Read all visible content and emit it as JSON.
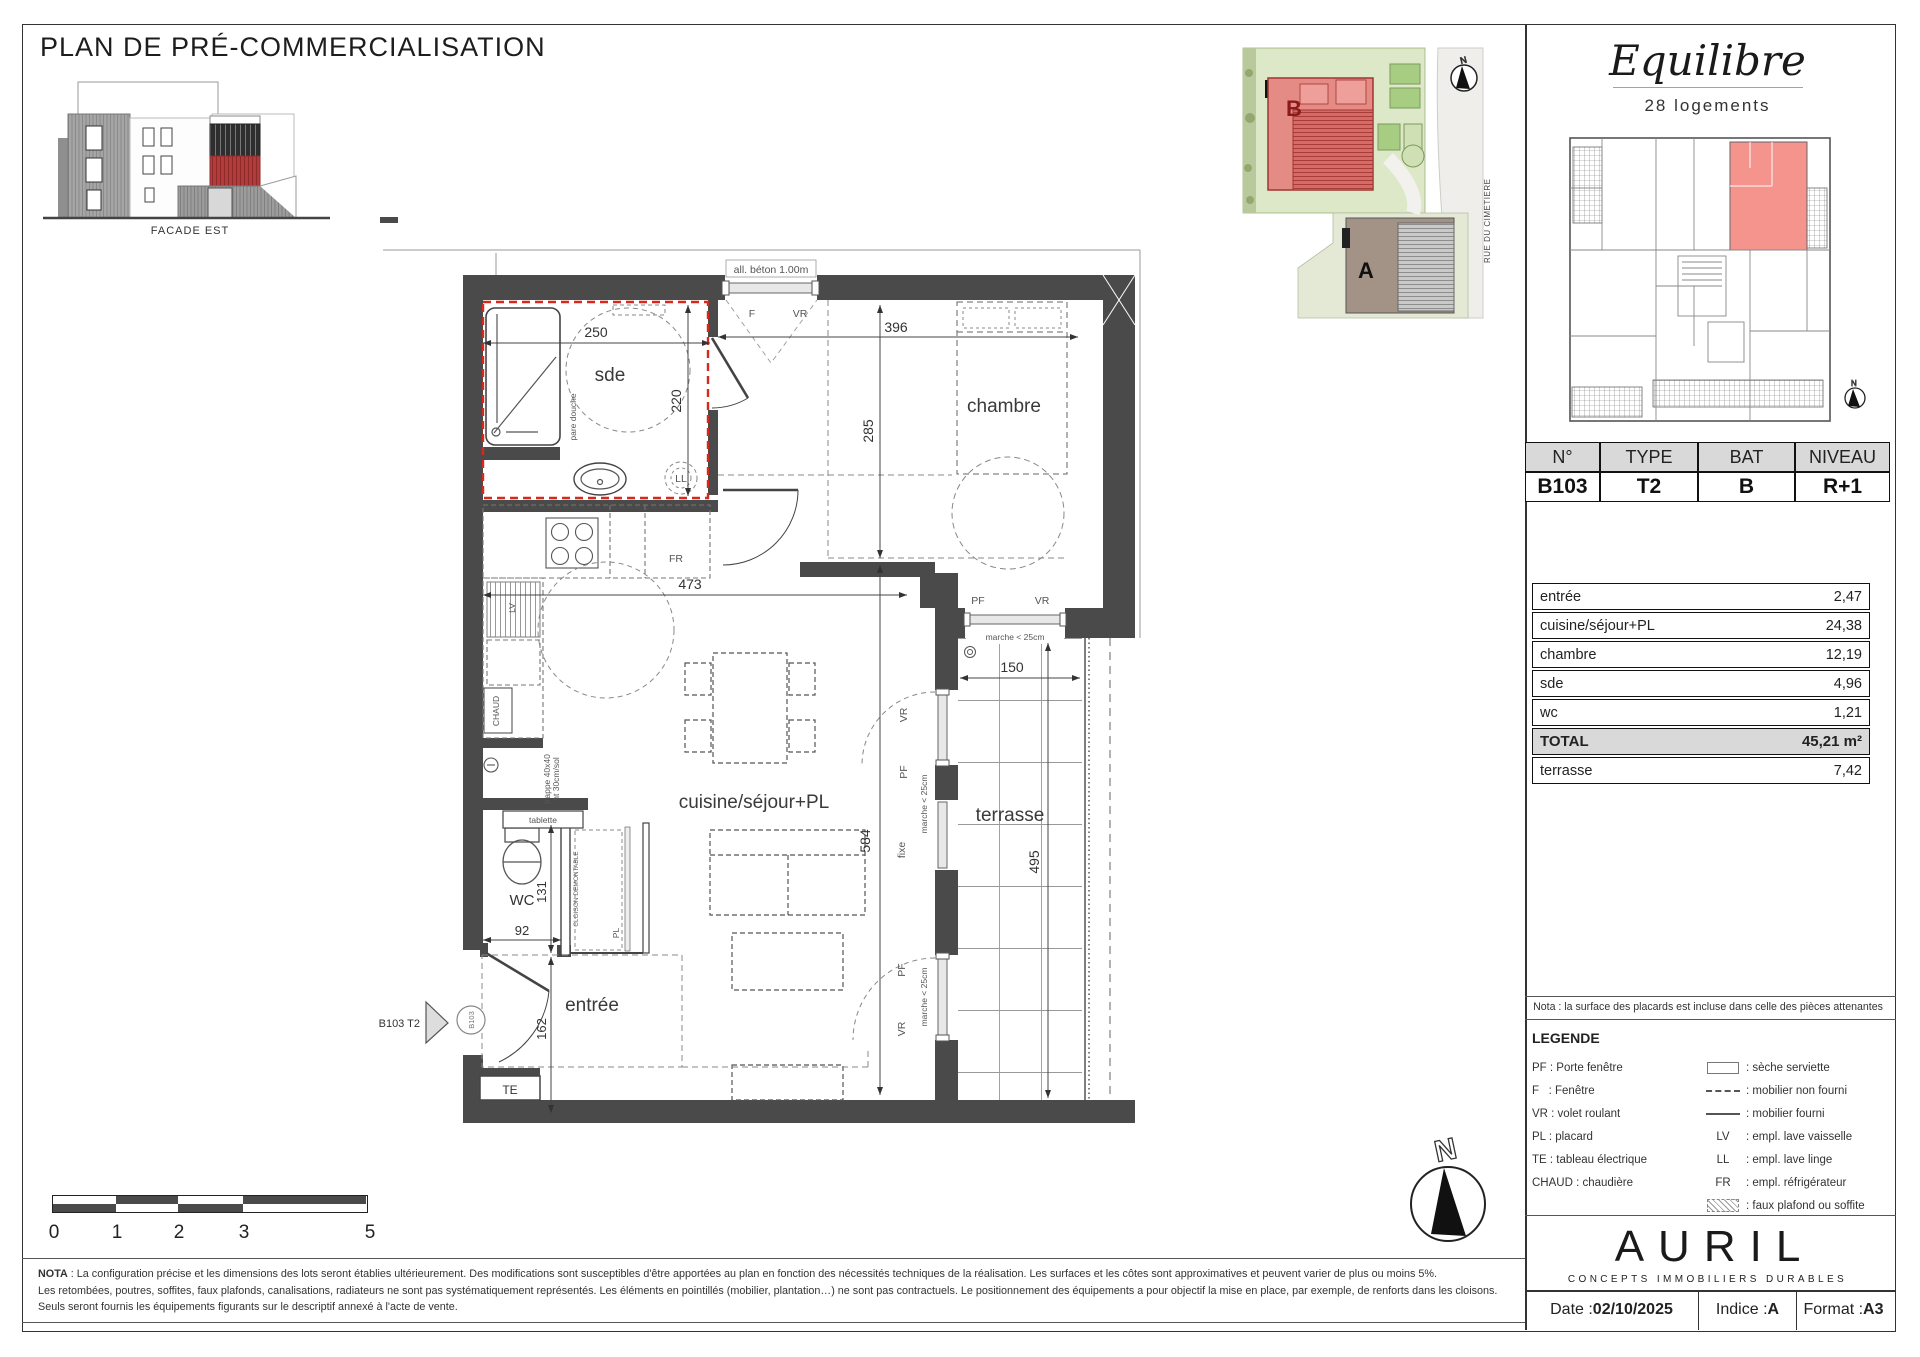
{
  "page": {
    "title": "PLAN DE PRÉ-COMMERCIALISATION"
  },
  "facade": {
    "label": "FACADE EST"
  },
  "site": {
    "building_b": "B",
    "building_a": "A",
    "street": "RUE DU CIMETIERE",
    "north": "N"
  },
  "project": {
    "name": "Equilibre",
    "units": "28 logements"
  },
  "unit_table": {
    "h_no": "N°",
    "h_type": "TYPE",
    "h_bat": "BAT",
    "h_niveau": "NIVEAU",
    "no": "B103",
    "type": "T2",
    "bat": "B",
    "niveau": "R+1"
  },
  "areas": {
    "rows": [
      {
        "label": "entrée",
        "value": "2,47"
      },
      {
        "label": "cuisine/séjour+PL",
        "value": "24,38"
      },
      {
        "label": "chambre",
        "value": "12,19"
      },
      {
        "label": "sde",
        "value": "4,96"
      },
      {
        "label": "wc",
        "value": "1,21"
      }
    ],
    "total_label": "TOTAL",
    "total_value": "45,21 m²",
    "terrasse_label": "terrasse",
    "terrasse_value": "7,42"
  },
  "plan": {
    "rooms": {
      "sde": "sde",
      "chambre": "chambre",
      "sejour": "cuisine/séjour+PL",
      "wc": "WC",
      "entree": "entrée",
      "terrasse": "terrasse",
      "te": "TE"
    },
    "dims": {
      "d250": "250",
      "d220": "220",
      "d396": "396",
      "d285": "285",
      "d473": "473",
      "d584": "584",
      "d131": "131",
      "d92": "92",
      "d162": "162",
      "d150": "150",
      "d495": "495"
    },
    "ann": {
      "all_beton": "all. béton 1.00m",
      "f": "F",
      "vr": "VR",
      "pf": "PF",
      "fixe": "fixe",
      "pare_douche": "pare douche",
      "ll": "LL",
      "lv": "LV",
      "fr": "FR",
      "chaud": "CHAUD",
      "trappe1": "trappe 40x40",
      "trappe2": "ht 30cm/sol",
      "tablette": "tablette",
      "cloison": "CLOISON DEMONTABLE",
      "pl": "PL",
      "marche": "marche < 25cm",
      "unit_tag": "B103 T2",
      "unit_circle": "B103",
      "north": "N"
    }
  },
  "scalebar": {
    "t0": "0",
    "t1": "1",
    "t2": "2",
    "t3": "3",
    "t5": "5"
  },
  "nota": {
    "bold": "NOTA",
    "line1": " : La configuration précise et les dimensions des lots seront établies ultérieurement. Des modifications sont susceptibles d'être apportées au plan en fonction des nécessités techniques de la réalisation. Les surfaces et les côtes sont approximatives et peuvent varier de plus ou moins 5%.",
    "line2": "Les retombées, poutres, soffites, faux plafonds, canalisations, radiateurs ne sont pas systématiquement représentés. Les éléments en pointillés (mobilier, plantation…) ne sont pas contractuels. Le positionnement des équipements a pour objectif la mise en place, par exemple, de renforts dans les cloisons.",
    "line3": "Seuls seront fournis les équipements figurants sur le descriptif annexé à l'acte de vente."
  },
  "panel_nota": "Nota : la surface des placards est incluse dans celle des pièces attenantes",
  "legend": {
    "title": "LEGENDE",
    "left": [
      "PF : Porte fenêtre",
      "F   : Fenêtre",
      "VR : volet roulant",
      "PL : placard",
      "TE : tableau électrique",
      "CHAUD : chaudière"
    ],
    "right": [
      {
        "sym": "",
        "label": ": sèche serviette"
      },
      {
        "sym": "",
        "label": ": mobilier non fourni"
      },
      {
        "sym": "",
        "label": ": mobilier fourni"
      },
      {
        "sym": "LV",
        "label": ": empl. lave vaisselle"
      },
      {
        "sym": "LL",
        "label": ": empl. lave linge"
      },
      {
        "sym": "FR",
        "label": ": empl. réfrigérateur"
      },
      {
        "sym": "",
        "label": ": faux plafond ou soffite"
      }
    ]
  },
  "brand": {
    "name": "AURIL",
    "tagline": "CONCEPTS IMMOBILIERS DURABLES"
  },
  "footer": {
    "date_label": "Date : ",
    "date": "02/10/2025",
    "indice_label": "Indice : ",
    "indice": "A",
    "format_label": "Format : ",
    "format": "A3"
  },
  "colors": {
    "wall": "#4a4a4a",
    "accent_red": "#d8281e",
    "unit_pink": "#f5938d",
    "table_grey": "#d9d9d9"
  }
}
